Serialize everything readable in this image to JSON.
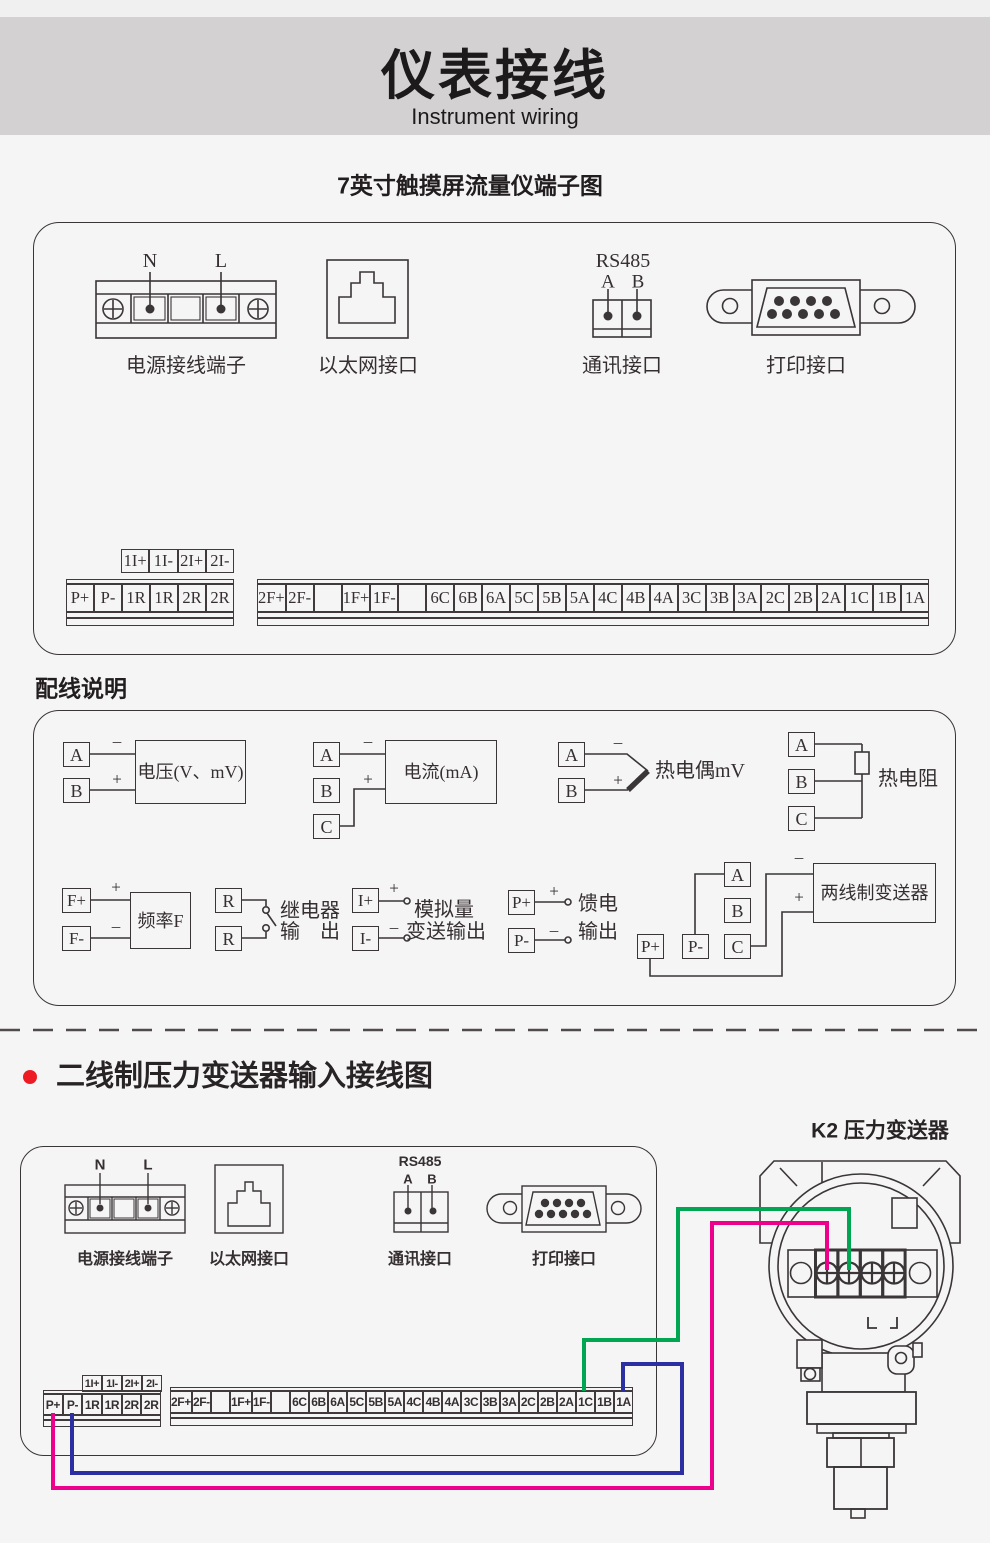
{
  "symbols": {
    "plus": "+",
    "minus": "–"
  },
  "header": {
    "title": "仪表接线",
    "subtitle": "Instrument wiring",
    "band_color": "#d3d1d2"
  },
  "diagram1": {
    "title": "7英寸触摸屏流量仪端子图",
    "power": {
      "label": "电源接线端子",
      "n": "N",
      "l": "L"
    },
    "ethernet": {
      "label": "以太网接口"
    },
    "comm": {
      "label": "通讯接口",
      "protocol": "RS485",
      "a": "A",
      "b": "B"
    },
    "printer": {
      "label": "打印接口"
    },
    "strips": {
      "aux": [
        "1I+",
        "1I-",
        "2I+",
        "2I-"
      ],
      "left": [
        "P+",
        "P-",
        "1R",
        "1R",
        "2R",
        "2R"
      ],
      "right": [
        "2F+",
        "2F-",
        "",
        "1F+",
        "1F-",
        "",
        "6C",
        "6B",
        "6A",
        "5C",
        "5B",
        "5A",
        "4C",
        "4B",
        "4A",
        "3C",
        "3B",
        "3A",
        "2C",
        "2B",
        "2A",
        "1C",
        "1B",
        "1A"
      ]
    }
  },
  "wiring": {
    "heading": "配线说明",
    "voltage": {
      "a": "A",
      "b": "B",
      "label": "电压(V、mV)"
    },
    "current": {
      "a": "A",
      "b": "B",
      "c": "C",
      "label": "电流(mA)"
    },
    "thermocouple": {
      "a": "A",
      "b": "B",
      "label": "热电偶mV"
    },
    "rtd": {
      "a": "A",
      "b": "B",
      "c": "C",
      "label": "热电阻"
    },
    "frequency": {
      "fp": "F+",
      "fm": "F-",
      "label": "频率F"
    },
    "relay": {
      "r1": "R",
      "r2": "R",
      "line1": "继电器",
      "line2": "输　出"
    },
    "analog": {
      "ip": "I+",
      "im": "I-",
      "line1": "模拟量",
      "line2": "变送输出"
    },
    "feed": {
      "pp": "P+",
      "pm": "P-",
      "line1": "馈电",
      "line2": "输出"
    },
    "two_wire": {
      "a": "A",
      "b": "B",
      "c": "C",
      "pp": "P+",
      "pm": "P-",
      "label": "两线制变送器"
    }
  },
  "section2": {
    "bullet_color": "#ed1c24",
    "title": "二线制压力变送器输入接线图",
    "device_label": "K2 压力变送器",
    "power": {
      "label": "电源接线端子",
      "n": "N",
      "l": "L"
    },
    "ethernet": {
      "label": "以太网接口"
    },
    "comm": {
      "label": "通讯接口",
      "protocol": "RS485",
      "a": "A",
      "b": "B"
    },
    "printer": {
      "label": "打印接口"
    },
    "strips": {
      "aux": [
        "1I+",
        "1I-",
        "2I+",
        "2I-"
      ],
      "left": [
        "P+",
        "P-",
        "1R",
        "1R",
        "2R",
        "2R"
      ],
      "right": [
        "2F+",
        "2F-",
        "",
        "1F+",
        "1F-",
        "",
        "6C",
        "6B",
        "6A",
        "5C",
        "5B",
        "5A",
        "4C",
        "4B",
        "4A",
        "3C",
        "3B",
        "3A",
        "2C",
        "2B",
        "2A",
        "1C",
        "1B",
        "1A"
      ]
    },
    "transmitter": {
      "s1": "+",
      "s2": "–",
      "s3": "+",
      "s4": "–",
      "t1": "A",
      "t2": "B",
      "loop": "A"
    },
    "wires": {
      "green": "#00a651",
      "magenta": "#ec008c",
      "blue": "#2b2fa2"
    }
  }
}
